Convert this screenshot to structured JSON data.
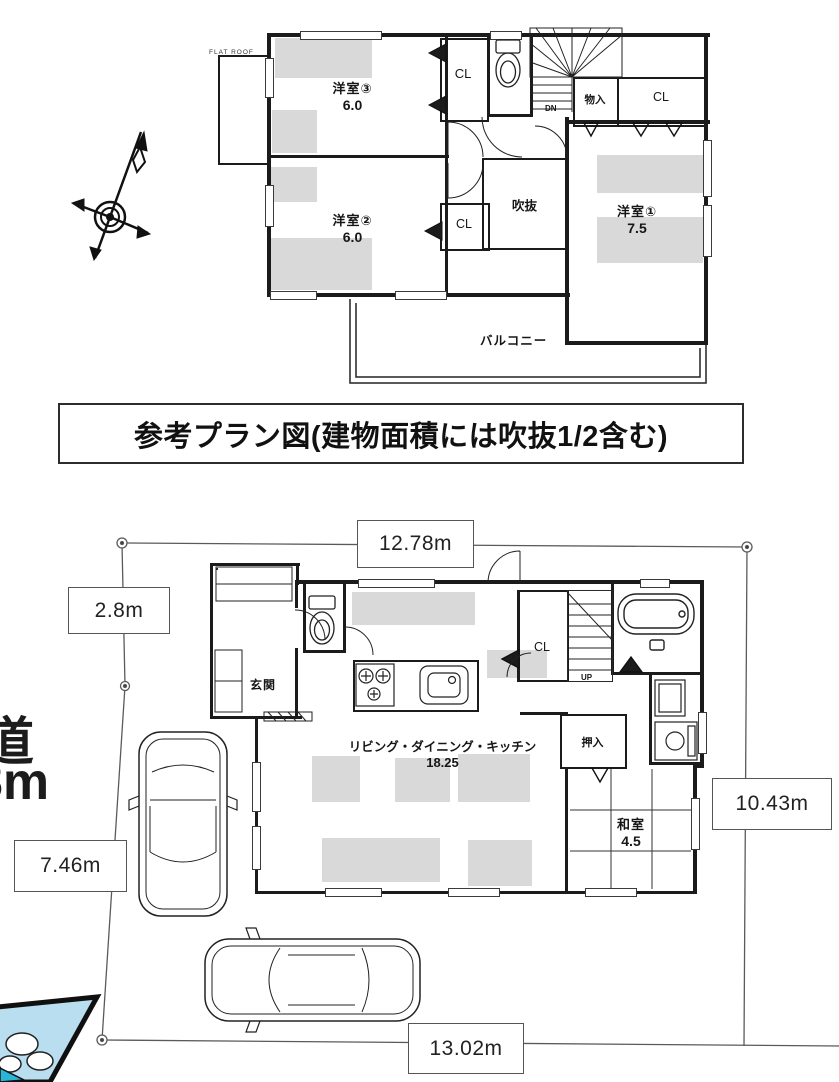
{
  "title_band": "参考プラン図(建物面積には吹抜1/2含む)",
  "floor2": {
    "flat_roof_label": "FLAT ROOF",
    "room_w3_name": "洋室③",
    "room_w3_size": "6.0",
    "room_w2_name": "洋室②",
    "room_w2_size": "6.0",
    "room_w1_name": "洋室①",
    "room_w1_size": "7.5",
    "closet_top": "CL",
    "closet_mid": "CL",
    "closet_right": "CL",
    "storage": "物入",
    "void": "吹抜",
    "stairs_dn": "DN",
    "balcony": "バルコニー"
  },
  "floor1": {
    "entrance": "玄関",
    "ldk_name": "リビング・ダイニング・キッチン",
    "ldk_size": "18.25",
    "closet": "CL",
    "stairs_up": "UP",
    "oshiire": "押入",
    "washitsu_name": "和室",
    "washitsu_size": "4.5"
  },
  "site": {
    "dim_top": "12.78m",
    "dim_left_upper": "2.8m",
    "dim_left_lower": "7.46m",
    "dim_right": "10.43m",
    "dim_bottom": "13.02m",
    "road_kanji": "道",
    "road_width": "8m"
  },
  "icons": {
    "compass": "compass-rose",
    "toilet_2f": "toilet-icon",
    "toilet_1f": "toilet-icon",
    "bathtub": "bathtub-icon",
    "stove": "stove-icon",
    "sink": "sink-icon",
    "car_upper": "car-top-view",
    "car_lower": "car-top-view",
    "corner_graphic": "blue-corner-graphic"
  },
  "colors": {
    "wall": "#1b1b1b",
    "line": "#444444",
    "hatch": "#d9d9d9",
    "blue_graphic": "#b8def0"
  }
}
